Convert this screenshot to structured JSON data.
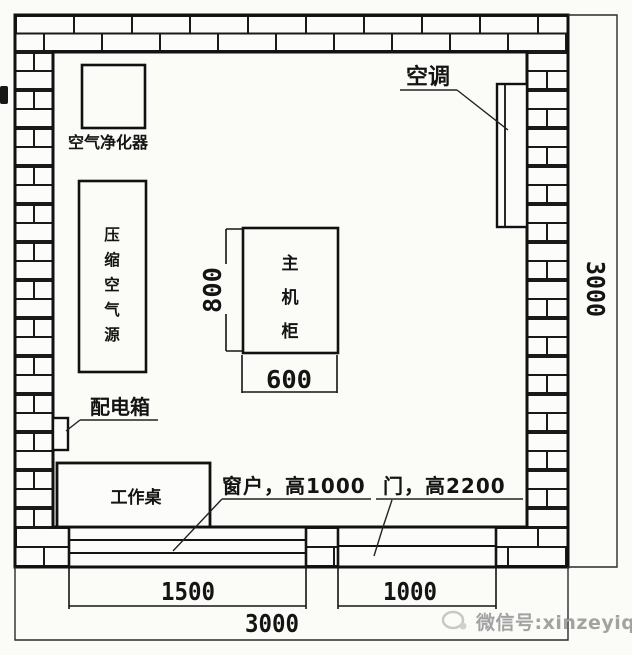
{
  "colors": {
    "line": "#1a1a1a",
    "background": "#fbfbf8",
    "watermark_grey": "#a2a2a2"
  },
  "plan": {
    "equipment": {
      "air_purifier": {
        "label": "空气净化器"
      },
      "compressed_air_source": {
        "label": "压缩空气源",
        "chars": [
          "压",
          "缩",
          "空",
          "气",
          "源"
        ]
      },
      "main_cabinet": {
        "label": "主机柜",
        "chars": [
          "主",
          "机",
          "柜"
        ],
        "width_mm": "600",
        "depth_mm": "800"
      },
      "air_conditioner": {
        "label": "空调"
      },
      "distribution_box": {
        "label": "配电箱"
      },
      "work_desk": {
        "label": "工作桌"
      }
    },
    "openings": {
      "window": {
        "note": "窗户，高1000",
        "width_mm": "1500"
      },
      "door": {
        "note": "门，高2200",
        "width_mm": "1000"
      }
    },
    "room": {
      "width_mm": "3000",
      "depth_mm": "3000"
    }
  },
  "watermark": {
    "text": "微信号:xinzeyiqi"
  }
}
